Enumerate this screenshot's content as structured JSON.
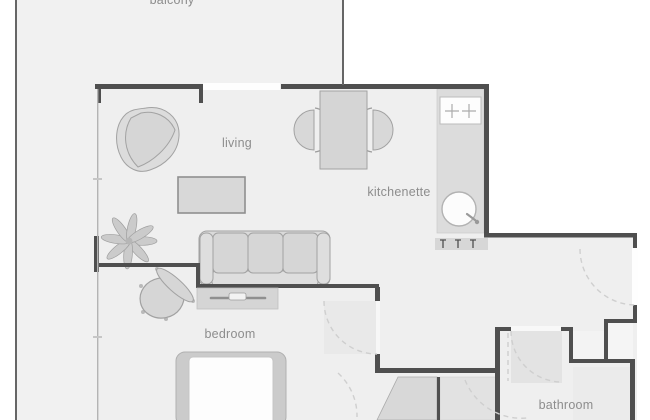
{
  "plan": {
    "rooms": [
      {
        "id": "balcony",
        "label": "balcony"
      },
      {
        "id": "living",
        "label": "living"
      },
      {
        "id": "kitchenette",
        "label": "kitchenette"
      },
      {
        "id": "bedroom",
        "label": "bedroom"
      },
      {
        "id": "bathroom",
        "label": "bathroom"
      }
    ],
    "furniture": [
      "armchair",
      "coffee-table",
      "dining-table",
      "dining-chair",
      "dining-chair",
      "sofa",
      "tv-stand",
      "plant",
      "side-table",
      "bench",
      "bed",
      "wardrobe",
      "closet",
      "kitchen-counter",
      "cooktop",
      "sink",
      "radiator"
    ],
    "openings": [
      "window",
      "entrance-door",
      "bedroom-door",
      "bathroom-door"
    ],
    "colors": {
      "background": "#ffffff",
      "wall": "#4f4f4f",
      "rail": "#666666",
      "floor": "#efefef",
      "balcony_floor": "#f1f1f1",
      "furniture_fill": "#d7d7d7",
      "furniture_stroke": "#a2a2a2",
      "counter_fill": "#dcdcdc",
      "shading": "#e4e4e4",
      "door_swing": "#cfcfcf",
      "label_text": "#8d8d8d"
    }
  }
}
